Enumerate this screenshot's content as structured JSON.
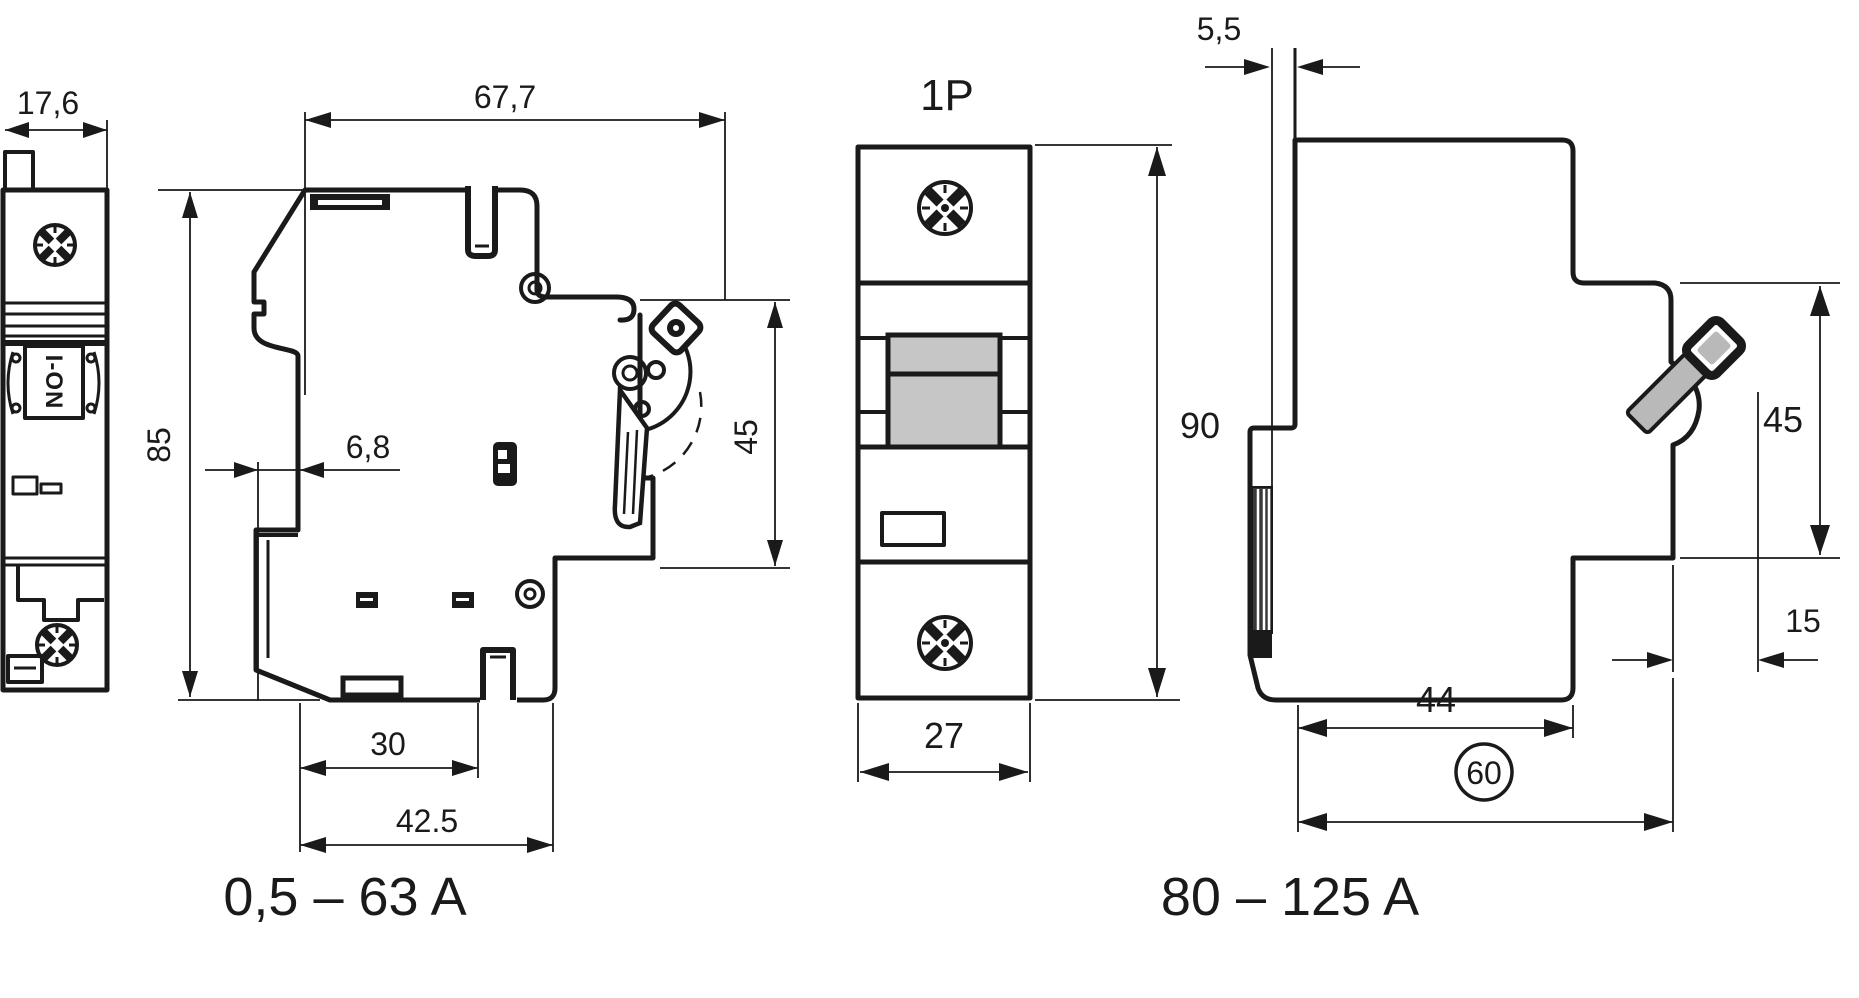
{
  "drawing": {
    "product_views": {
      "front_narrow": {
        "width_dim": "17,6",
        "toggle_label": "I-ON"
      },
      "side_small": {
        "depth_dim": "67,7",
        "height_dim": "85",
        "clip_offset_dim": "6,8",
        "pole_face_dim": "45",
        "rail_center_dim": "30",
        "base_depth_dim": "42.5",
        "rating_label": "0,5 – 63 A"
      },
      "front_1p": {
        "title": "1P",
        "height_dim": "90",
        "width_dim": "27"
      },
      "side_large": {
        "rail_offset_dim": "5,5",
        "pole_face_dim": "45",
        "toggle_protrusion_dim": "15",
        "lower_depth_dim": "44",
        "total_depth_dim": "60",
        "rating_label": "80 – 125 A"
      }
    }
  }
}
